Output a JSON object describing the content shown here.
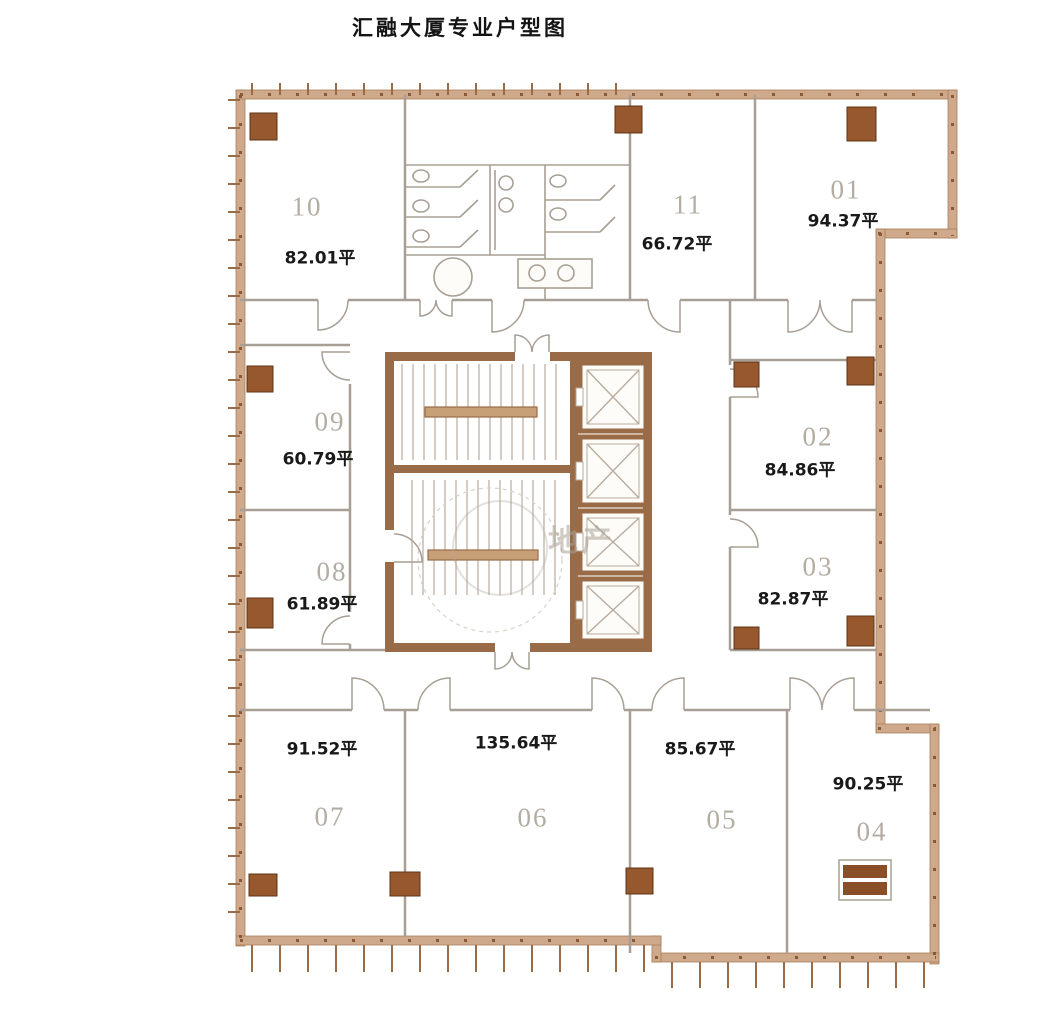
{
  "title": "汇融大厦专业户型图",
  "watermark_text": "地产",
  "units": [
    {
      "number": "01",
      "area": "94.37平"
    },
    {
      "number": "02",
      "area": "84.86平"
    },
    {
      "number": "03",
      "area": "82.87平"
    },
    {
      "number": "04",
      "area": "90.25平"
    },
    {
      "number": "05",
      "area": "85.67平"
    },
    {
      "number": "06",
      "area": "135.64平"
    },
    {
      "number": "07",
      "area": "91.52平"
    },
    {
      "number": "08",
      "area": "61.89平"
    },
    {
      "number": "09",
      "area": "60.79平"
    },
    {
      "number": "10",
      "area": "82.01平"
    },
    {
      "number": "11",
      "area": "66.72平"
    }
  ],
  "colors": {
    "outer_wall": "#cfa98c",
    "outer_wall_stud": "#8a5a38",
    "core_wall": "#9a6b47",
    "column": "#96582c",
    "thin_line": "#a89f94",
    "unit_number_text": "#b3aca2",
    "area_text": "#191919"
  }
}
